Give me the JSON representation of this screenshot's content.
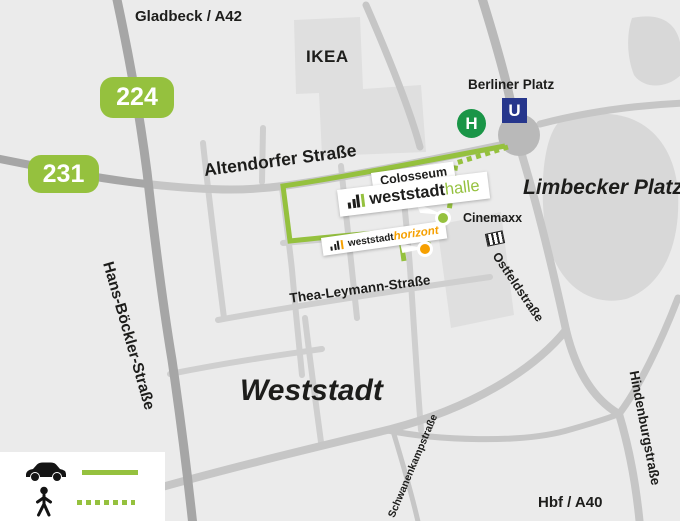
{
  "title": "Weststadt area map",
  "labels": {
    "gladbeck": "Gladbeck / A42",
    "ikea": "IKEA",
    "badge_224": "224",
    "badge_231": "231",
    "altendorfer": "Altendorfer Straße",
    "berliner_platz": "Berliner Platz",
    "u_symbol": "U",
    "h_symbol": "H",
    "limbecker_platz": "Limbecker Platz",
    "colosseum": "Colosseum",
    "weststadthalle": {
      "prefix": "weststadt",
      "suffix": "halle"
    },
    "weststadthorizont": {
      "prefix": "weststadt",
      "suffix": "horizont"
    },
    "cinemaxx": "Cinemaxx",
    "ostfeldstrasse": "Ostfeldstraße",
    "thea_leymann": "Thea-Leymann-Straße",
    "weststadt": "Weststadt",
    "hans_boeckler": "Hans-Böckler-Straße",
    "schwanenkamp": "Schwanenkampstraße",
    "hindenburg": "Hindenburgstraße",
    "hbf": "Hbf / A40"
  },
  "legend": {
    "items": [
      {
        "icon": "car-icon",
        "line_style": "solid"
      },
      {
        "icon": "pedestrian-icon",
        "line_style": "dotted"
      }
    ]
  },
  "colors": {
    "route_green": "#95c13e",
    "h_stop_green": "#1a9547",
    "u_bahn_blue": "#26368c",
    "horizont_orange": "#f6a000"
  }
}
